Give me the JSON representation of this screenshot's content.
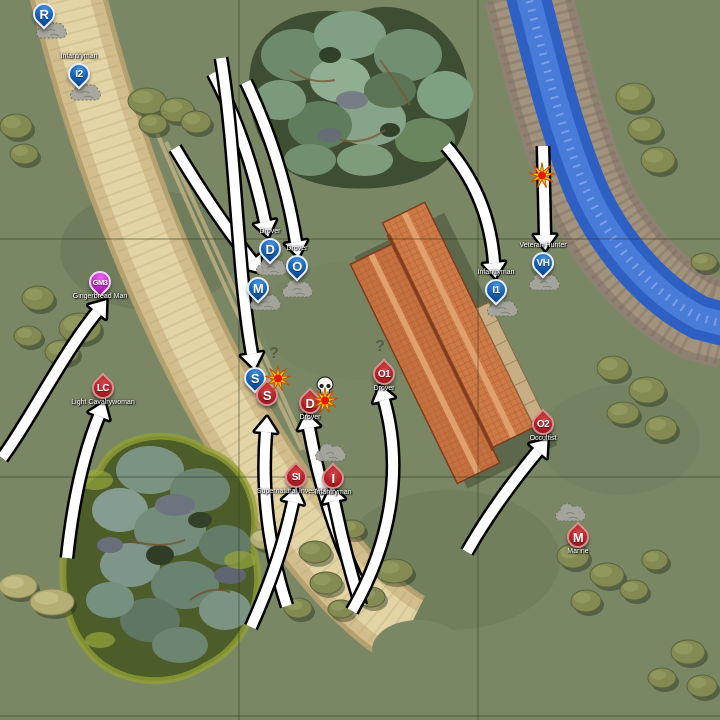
{
  "map": {
    "width": 720,
    "height": 720,
    "grid": {
      "vertical": [
        239,
        478
      ],
      "horizontal": [
        239,
        477,
        716
      ]
    }
  },
  "colors": {
    "field": "#7a8765",
    "grid_line": "#2c3a20",
    "road": "#d2be8d",
    "road_edge": "#b5a070",
    "road_center": "#e3d4a5",
    "water": "#2e5fc2",
    "water_light": "#5082dd",
    "river_bank": "#988a79",
    "forest_base": "#3e4e33",
    "moss": "#93a233",
    "roof": "#c5713f",
    "roof_light": "#cd7a46",
    "roof_ridge": "#dfa06c",
    "roof_line": "#a5512b",
    "walkway": "#c8ae85",
    "arrow_fill": "#ffffff",
    "arrow_outline": "#000000",
    "pin_blue": "#1360b2",
    "drop_red": "#b02026",
    "pin_magenta": "#c32cc9",
    "smoke": "#a6a69e",
    "explosion_yellow": "#ffd400",
    "explosion_red": "#e81800",
    "skull": "#f4f4ec"
  },
  "units": [
    {
      "id": "blue-R",
      "letter": "R",
      "faction": "blue",
      "shape": "pin",
      "x": 44,
      "y": 14
    },
    {
      "id": "blue-I2",
      "letter": "I2",
      "faction": "blue",
      "shape": "pin",
      "x": 79,
      "y": 74,
      "label": "Infantryman",
      "label_side": "above"
    },
    {
      "id": "blue-D",
      "letter": "D",
      "faction": "blue",
      "shape": "pin",
      "x": 270,
      "y": 249,
      "label": "Drover",
      "label_side": "above"
    },
    {
      "id": "blue-O",
      "letter": "O",
      "faction": "blue",
      "shape": "pin",
      "x": 297,
      "y": 266,
      "label": "Drover",
      "label_side": "above"
    },
    {
      "id": "blue-M",
      "letter": "M",
      "faction": "blue",
      "shape": "pin",
      "x": 258,
      "y": 288
    },
    {
      "id": "blue-S",
      "letter": "S",
      "faction": "blue",
      "shape": "pin",
      "x": 255,
      "y": 378
    },
    {
      "id": "blue-I1",
      "letter": "I1",
      "faction": "blue",
      "shape": "pin",
      "x": 496,
      "y": 290,
      "label": "Infantryman",
      "label_side": "above"
    },
    {
      "id": "blue-VH",
      "letter": "VH",
      "faction": "blue",
      "shape": "pin",
      "x": 543,
      "y": 263,
      "label": "Veteran Hunter",
      "label_side": "above"
    },
    {
      "id": "red-S",
      "letter": "S",
      "faction": "red",
      "shape": "drop",
      "x": 267,
      "y": 395
    },
    {
      "id": "red-D",
      "letter": "D",
      "faction": "red",
      "shape": "drop",
      "x": 310,
      "y": 403,
      "label": "Drover",
      "label_side": "below"
    },
    {
      "id": "red-O1",
      "letter": "O1",
      "faction": "red",
      "shape": "drop",
      "x": 384,
      "y": 374,
      "label": "Drover",
      "label_side": "below"
    },
    {
      "id": "red-SI",
      "letter": "SI",
      "faction": "red",
      "shape": "drop",
      "x": 296,
      "y": 477,
      "label": "Supernatural Investigator",
      "label_side": "below"
    },
    {
      "id": "red-I",
      "letter": "I",
      "faction": "red",
      "shape": "drop",
      "x": 333,
      "y": 478,
      "label": "Infantryman",
      "label_side": "below"
    },
    {
      "id": "red-LC",
      "letter": "LC",
      "faction": "red",
      "shape": "drop",
      "x": 103,
      "y": 388,
      "label": "Light Cavalrywoman",
      "label_side": "below"
    },
    {
      "id": "red-O2",
      "letter": "O2",
      "faction": "red",
      "shape": "drop",
      "x": 543,
      "y": 424,
      "label": "Occultist",
      "label_side": "below"
    },
    {
      "id": "red-M",
      "letter": "M",
      "faction": "red",
      "shape": "drop",
      "x": 578,
      "y": 537,
      "label": "Marine",
      "label_side": "below"
    },
    {
      "id": "special-GM3",
      "letter": "GM3",
      "faction": "magenta",
      "shape": "pin",
      "x": 100,
      "y": 282,
      "label": "Gingerbread Man",
      "label_side": "below"
    }
  ],
  "effects": {
    "smoke": [
      [
        54,
        33
      ],
      [
        88,
        95
      ],
      [
        274,
        270
      ],
      [
        300,
        292
      ],
      [
        268,
        305
      ],
      [
        505,
        311
      ],
      [
        547,
        285
      ],
      [
        333,
        456
      ],
      [
        573,
        516
      ]
    ],
    "explosions": [
      [
        278,
        381
      ],
      [
        325,
        403
      ],
      [
        542,
        178
      ]
    ],
    "skulls": [
      [
        325,
        388
      ]
    ],
    "question_marks": [
      [
        274,
        354
      ],
      [
        380,
        347
      ]
    ]
  },
  "arrows": [
    {
      "id": "to-blue-D",
      "path": "M213,73 Q248,140 265,222"
    },
    {
      "id": "to-blue-O",
      "path": "M246,82 Q283,160 296,242"
    },
    {
      "id": "to-blue-M",
      "path": "M175,148 Q215,215 252,261"
    },
    {
      "id": "to-blue-S",
      "path": "M221,58 C236,150 237,270 252,354"
    },
    {
      "id": "to-GM3",
      "path": "M2,458 C30,420 62,355 97,312"
    },
    {
      "id": "to-red-LC",
      "path": "M67,558 Q76,472 99,416"
    },
    {
      "id": "to-red-S",
      "path": "M287,606 Q259,520 266,432"
    },
    {
      "id": "to-red-SI",
      "path": "M251,627 Q281,560 293,502"
    },
    {
      "id": "to-red-D",
      "path": "M356,578 Q324,510 309,428"
    },
    {
      "id": "to-red-I",
      "path": "M361,606 Q345,555 334,501"
    },
    {
      "id": "to-red-O1",
      "path": "M352,611 C390,545 404,470 384,400"
    },
    {
      "id": "to-blue-I1",
      "path": "M446,146 Q489,195 494,263"
    },
    {
      "id": "to-blue-VH",
      "path": "M543,146 L545,235"
    },
    {
      "id": "to-red-O2",
      "path": "M467,552 Q494,504 538,451"
    }
  ]
}
